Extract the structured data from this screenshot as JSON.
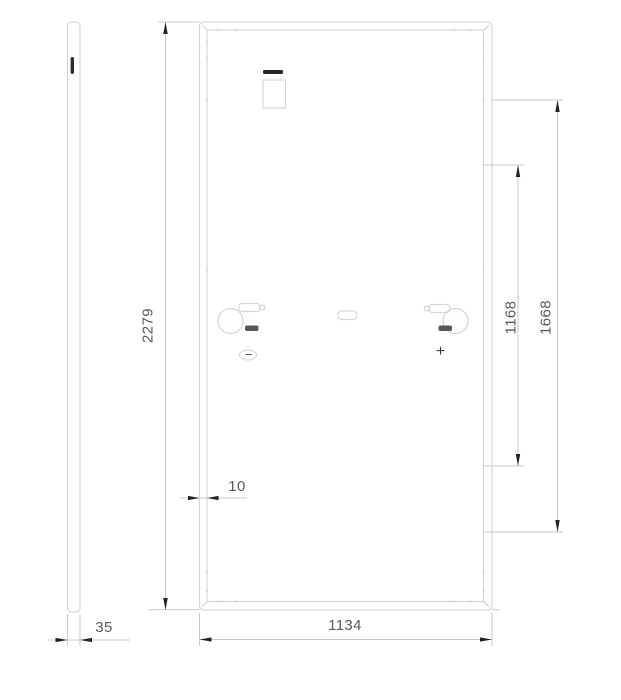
{
  "dimensions": {
    "module_height": "2279",
    "module_width": "1134",
    "module_thickness": "35",
    "frame_width": "10",
    "mounting_span_inner": "1168",
    "mounting_span_outer": "1668"
  },
  "labels": {
    "polarity_negative": "−",
    "polarity_positive": "+"
  },
  "colors": {
    "background": "#ffffff",
    "outline": "#d4d7da",
    "dimension_line": "#c7cacd",
    "arrow": "#202225",
    "text": "#565a5e",
    "dark_fill": "#2a2c2e"
  }
}
